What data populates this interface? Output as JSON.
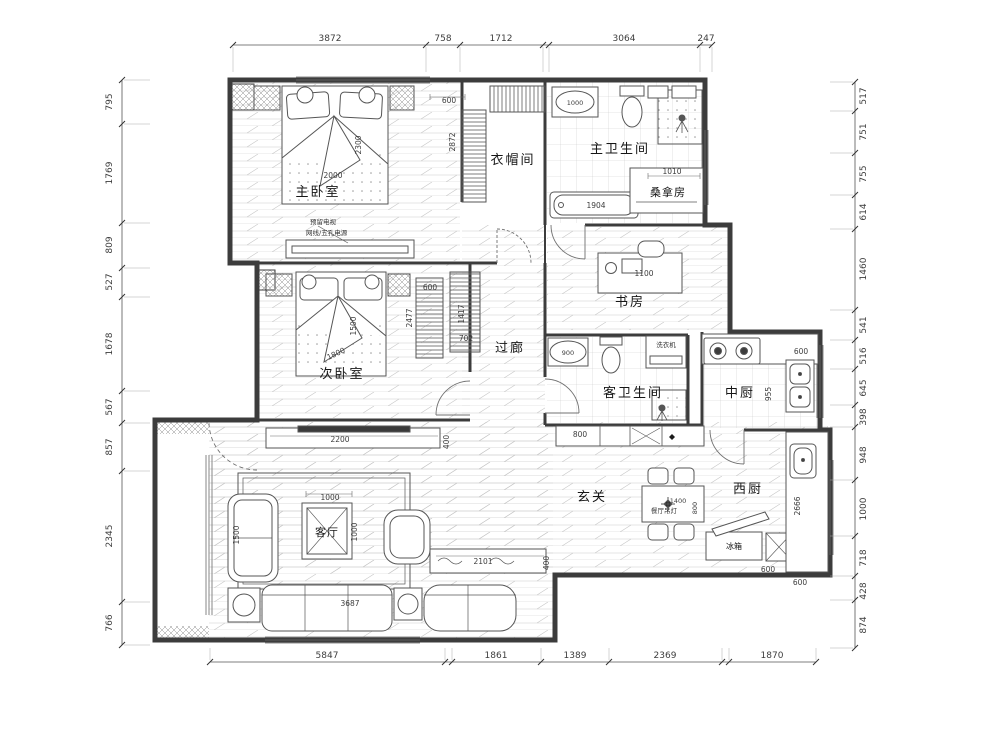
{
  "colors": {
    "wall": "#3c3c3c",
    "thin_line": "#5a5a5a",
    "hatch": "#c3c3c3",
    "dim_text": "#3d3d3d"
  },
  "dims": {
    "top": [
      "3872",
      "758",
      "1712",
      "3064",
      "247"
    ],
    "left": [
      "795",
      "1769",
      "809",
      "527",
      "1678",
      "567",
      "857",
      "2345",
      "766"
    ],
    "right": [
      "517",
      "751",
      "755",
      "614",
      "1460",
      "541",
      "516",
      "645",
      "398",
      "948",
      "1000",
      "718",
      "428",
      "874"
    ],
    "bottom": [
      "5847",
      "1861",
      "1389",
      "2369",
      "1870"
    ]
  },
  "rooms": {
    "master_bedroom": "主卧室",
    "cloakroom": "衣帽间",
    "master_bathroom": "主卫生间",
    "sauna": "桑拿房",
    "study": "书房",
    "second_bedroom": "次卧室",
    "corridor": "过廊",
    "guest_bathroom": "客卫生间",
    "chinese_kitchen": "中厨",
    "entrance": "玄关",
    "western_kitchen": "西厨",
    "living_room": "客厅"
  },
  "furniture_labels": {
    "dining_pendant": "餐厅吊灯",
    "fridge": "冰箱",
    "washing_machine": "洗衣机"
  },
  "notes": {
    "tv_reserved": "预留电视",
    "outlet": "网线/五孔电源"
  },
  "inner_dims": {
    "master_bed_width": "2000",
    "master_bed_length": "2300",
    "cloak_600": "600",
    "cloak_2872": "2872",
    "bath_tub_1000": "1000",
    "sauna_1010": "1010",
    "tub_1904": "1904",
    "desk_1100": "1100",
    "bed2_1500": "1500",
    "bed2_1800": "1800",
    "wardrobe_600": "600",
    "wardrobe_2477": "2477",
    "wardrobe_1417": "1417",
    "wardrobe_702": "702",
    "basin_900": "900",
    "hall_800": "800",
    "kitchen_600": "600",
    "kitchen_955": "955",
    "counter_2666": "2666",
    "counter_600": "600",
    "entry_cab_600": "600",
    "tv_2200": "2200",
    "tv_400": "400",
    "table_1000_w": "1000",
    "table_1000_h": "1000",
    "sofa_1500": "1500",
    "sofa_3687": "3687",
    "dining_1400": "1400",
    "dining_800": "800",
    "shoe_2101": "2101",
    "shoe_400": "400"
  }
}
